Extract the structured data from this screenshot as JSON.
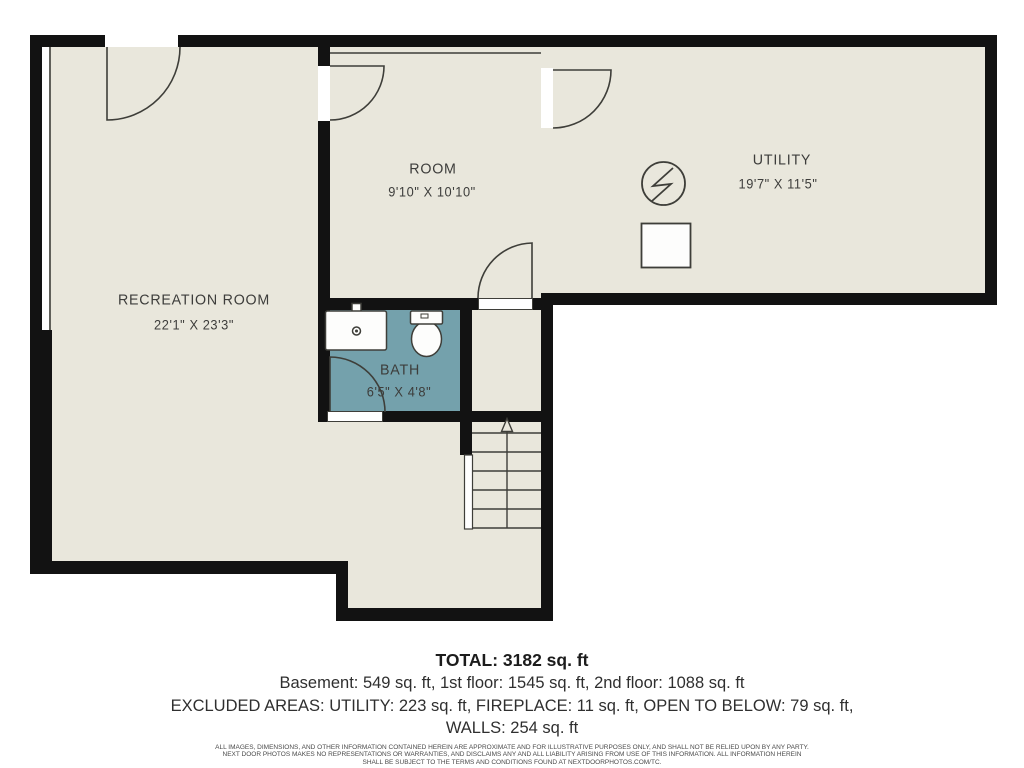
{
  "title": "Basement floor plan",
  "colors": {
    "background": "#ffffff",
    "floor": "#e9e7dc",
    "wall": "#121212",
    "bath": "#74a1ac",
    "line": "#3e3e39",
    "label_text": "#3d3d3b",
    "summary_text": "#333333",
    "fixture_fill": "#fdfdfc"
  },
  "rooms": {
    "recreation": {
      "name": "RECREATION ROOM",
      "dimensions": "22'1\" X 23'3\""
    },
    "room": {
      "name": "ROOM",
      "dimensions": "9'10\" X 10'10\""
    },
    "utility": {
      "name": "UTILITY",
      "dimensions": "19'7\" X 11'5\""
    },
    "bath": {
      "name": "BATH",
      "dimensions": "6'5\" X 4'8\""
    }
  },
  "summary": {
    "total": "TOTAL: 3182 sq. ft",
    "floors": "Basement: 549 sq. ft, 1st floor: 1545 sq. ft, 2nd floor: 1088 sq. ft",
    "excluded": "EXCLUDED AREAS: UTILITY: 223 sq. ft, FIREPLACE: 11 sq. ft, OPEN TO BELOW: 79 sq. ft,",
    "walls": "WALLS: 254 sq. ft"
  },
  "disclaimer": [
    "ALL IMAGES, DIMENSIONS, AND OTHER INFORMATION CONTAINED HEREIN ARE APPROXIMATE AND FOR ILLUSTRATIVE PURPOSES ONLY, AND SHALL NOT BE RELIED UPON BY ANY PARTY.",
    "NEXT DOOR PHOTOS MAKES NO REPRESENTATIONS OR WARRANTIES, AND DISCLAIMS ANY AND ALL LIABILITY ARISING FROM USE OF THIS INFORMATION. ALL INFORMATION HEREIN",
    "SHALL BE SUBJECT TO THE TERMS AND CONDITIONS FOUND AT NEXTDOORPHOTOS.COM/TC."
  ],
  "icons": {
    "electrical_panel": "lightning-bolt-circle-icon",
    "utility_fixture": "square-fixture-icon",
    "stairs": "stairs-up-arrow-icon",
    "sink": "bathroom-sink-icon",
    "toilet": "toilet-icon"
  }
}
